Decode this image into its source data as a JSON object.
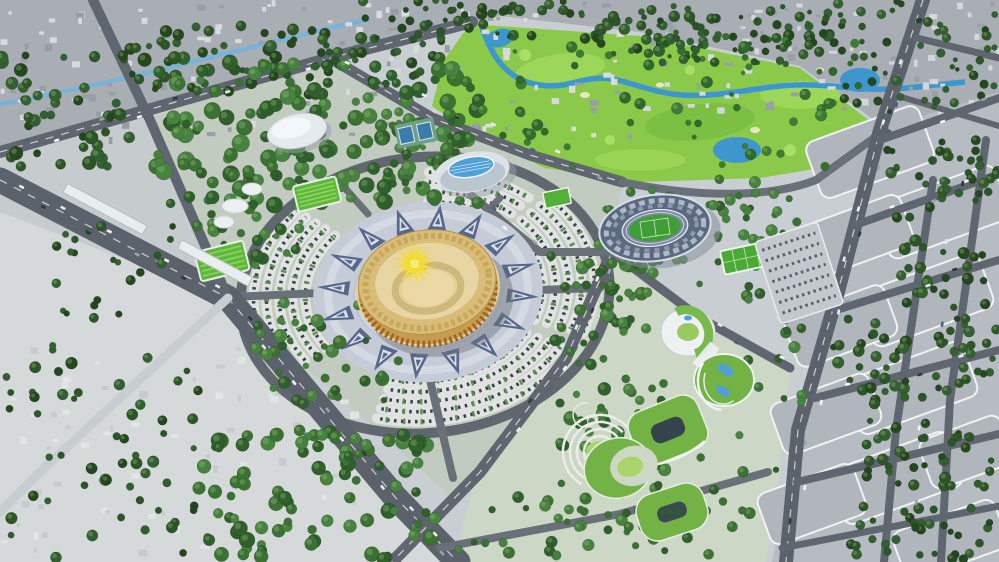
{
  "meta": {
    "description": "Aerial 3D masterplan rendering of a civic and sports complex: a golden circular arena with sun-motif roof on a patterned plaza, ringed by fan-shaped parking arcs, with an aquatic center, indoor dome hall, athletics stadium, golf course with winding river, green-roofed buildings, a dense old town, and a gridded city district"
  },
  "palette": {
    "base": "#c9ced2",
    "old_town": "#a8aeb4",
    "city_right": "#b6bcc2",
    "left_strip": "#c6cbce",
    "washed": "#d5d9da",
    "park": "#c2cbbf",
    "park_se": "#cdd7c5",
    "road": "#5c626c",
    "road_light": "#c8cdd1",
    "golf": "#8bc94a",
    "golf_light": "#9cd75a",
    "water": "#3e96cf",
    "canal": "#79b3d8",
    "plaza": "#c5cbd7",
    "plaza_triangle": "#57688c",
    "arena_wall": "#c89c4e",
    "arena_roof": "#d9bc77",
    "arena_inner": "#e7d6a3",
    "arena_arch": "#9a6524",
    "sun": "#f1dd33",
    "stands": "#5b6a80",
    "pitch": "#3f9e35",
    "track": "#7b89a0",
    "white_bldg": "#edf1f3",
    "green_roof": "#73b244",
    "lawn": "#a9d56a",
    "pool": "#4fa0d8"
  },
  "scene": {
    "tree_tones": {
      "dark": [
        "#24471f",
        "#2c5528",
        "#336030"
      ],
      "mid": [
        "#2f5f2b",
        "#3b7234",
        "#478240"
      ],
      "golf": [
        "#2e6a2a",
        "#3d7c33",
        "#356f2e"
      ]
    },
    "tree_regions": [
      [
        0,
        55,
        150,
        112,
        45,
        3,
        7,
        "dark"
      ],
      [
        130,
        25,
        200,
        72,
        52,
        3,
        7,
        "dark"
      ],
      [
        320,
        35,
        125,
        52,
        28,
        3,
        6,
        "dark"
      ],
      [
        360,
        0,
        250,
        40,
        55,
        2,
        6,
        "dark"
      ],
      [
        600,
        5,
        230,
        52,
        55,
        2,
        6,
        "dark"
      ],
      [
        833,
        0,
        164,
        112,
        55,
        2,
        5,
        "dark"
      ],
      [
        155,
        62,
        330,
        146,
        160,
        4,
        9,
        "mid"
      ],
      [
        185,
        170,
        118,
        98,
        38,
        3,
        7,
        "mid"
      ],
      [
        250,
        300,
        150,
        104,
        42,
        3,
        7,
        "mid"
      ],
      [
        195,
        425,
        240,
        134,
        92,
        4,
        8,
        "mid"
      ],
      [
        0,
        332,
        200,
        226,
        55,
        3,
        6,
        "dark"
      ],
      [
        55,
        226,
        118,
        92,
        22,
        3,
        5,
        "dark"
      ],
      [
        550,
        252,
        102,
        132,
        40,
        3,
        7,
        "mid"
      ],
      [
        556,
        382,
        112,
        148,
        46,
        3,
        7,
        "mid"
      ],
      [
        586,
        176,
        202,
        112,
        50,
        3,
        6,
        "mid"
      ],
      [
        742,
        186,
        70,
        232,
        30,
        3,
        6,
        "mid"
      ],
      [
        616,
        426,
        162,
        132,
        30,
        3,
        6,
        "mid"
      ],
      [
        456,
        496,
        206,
        62,
        26,
        3,
        6,
        "mid"
      ],
      [
        470,
        36,
        400,
        132,
        60,
        2,
        6,
        "golf"
      ],
      [
        640,
        16,
        190,
        48,
        40,
        2,
        5,
        "dark"
      ],
      [
        392,
        120,
        66,
        78,
        20,
        2,
        5,
        "mid"
      ],
      [
        826,
        300,
        60,
        108,
        22,
        3,
        6,
        "dark"
      ],
      [
        886,
        150,
        100,
        68,
        26,
        3,
        6,
        "dark"
      ],
      [
        900,
        240,
        90,
        68,
        24,
        3,
        6,
        "dark"
      ],
      [
        880,
        330,
        90,
        68,
        24,
        3,
        6,
        "dark"
      ],
      [
        862,
        420,
        90,
        68,
        24,
        3,
        6,
        "dark"
      ],
      [
        846,
        505,
        90,
        50,
        18,
        3,
        6,
        "dark"
      ],
      [
        940,
        140,
        58,
        58,
        13,
        3,
        5,
        "dark"
      ],
      [
        955,
        300,
        44,
        78,
        13,
        3,
        5,
        "dark"
      ],
      [
        930,
        432,
        66,
        78,
        17,
        3,
        5,
        "dark"
      ],
      [
        912,
        520,
        80,
        40,
        12,
        3,
        5,
        "dark"
      ]
    ],
    "bldg_regions": [
      [
        0,
        0,
        640,
        138,
        150,
        "#d8dbde",
        "#989ea6"
      ],
      [
        640,
        0,
        359,
        112,
        80,
        "#d3d7da",
        "#9aa0a8"
      ],
      [
        0,
        338,
        250,
        220,
        55,
        "#e2e5e6",
        "#c6cbce"
      ],
      [
        255,
        385,
        130,
        115,
        18,
        "#e2e5e6",
        "#c6cbce"
      ]
    ],
    "city_blocks": [
      [
        870,
        152,
        120,
        60
      ],
      [
        942,
        212,
        128,
        58
      ],
      [
        856,
        236,
        108,
        54
      ],
      [
        926,
        300,
        128,
        58
      ],
      [
        841,
        326,
        106,
        54
      ],
      [
        911,
        388,
        126,
        58
      ],
      [
        826,
        414,
        104,
        54
      ],
      [
        896,
        478,
        126,
        58
      ],
      [
        812,
        504,
        102,
        54
      ],
      [
        966,
        452,
        86,
        52
      ],
      [
        950,
        540,
        108,
        52
      ]
    ],
    "fan_center": {
      "cx": 425,
      "cy": 292,
      "sq": 0.76,
      "rot": -6
    },
    "fans": [
      {
        "a0": 150,
        "a1": 228,
        "radii": [
          120,
          133,
          146,
          159,
          172
        ]
      },
      {
        "a0": 35,
        "a1": 114,
        "radii": [
          118,
          131,
          144,
          157,
          170
        ]
      },
      {
        "a0": -38,
        "a1": 28,
        "radii": [
          118,
          131,
          144,
          157,
          170
        ]
      },
      {
        "a0": -84,
        "a1": -42,
        "radii": [
          118,
          131,
          144,
          157
        ]
      }
    ],
    "triangle_ring": {
      "rx1": 80,
      "ry1": 62,
      "rx2": 112,
      "ry2": 87,
      "n": 16,
      "color": "#57688c",
      "inner": "#dde2ea"
    },
    "sun": {
      "dx": -10,
      "dy": -26,
      "rays": 16,
      "r1": 9,
      "r2": 22,
      "color": "#f1dd33",
      "core": "#f6ea7a"
    },
    "car_colors": [
      "#f2f4f6",
      "#30373e",
      "#e8ebee",
      "#47637a",
      "#f2f4f6",
      "#9aa3ab"
    ],
    "car_lines": [
      [
        5,
        183,
        222,
        293,
        9
      ],
      [
        232,
        303,
        390,
        490,
        8
      ],
      [
        398,
        500,
        452,
        558,
        4
      ],
      [
        8,
        150,
        325,
        60,
        8
      ],
      [
        335,
        62,
        615,
        180,
        8
      ],
      [
        612,
        255,
        570,
        352,
        5
      ],
      [
        566,
        360,
        486,
        466,
        4
      ],
      [
        920,
        8,
        840,
        288,
        8
      ],
      [
        838,
        294,
        788,
        553,
        6
      ],
      [
        882,
        138,
        994,
        100,
        3
      ],
      [
        860,
        222,
        994,
        176,
        3
      ],
      [
        838,
        308,
        994,
        262,
        3
      ],
      [
        817,
        396,
        994,
        352,
        3
      ],
      [
        965,
        140,
        905,
        552,
        5
      ],
      [
        702,
        320,
        786,
        364,
        3
      ],
      [
        475,
        198,
        538,
        250,
        3
      ]
    ]
  }
}
